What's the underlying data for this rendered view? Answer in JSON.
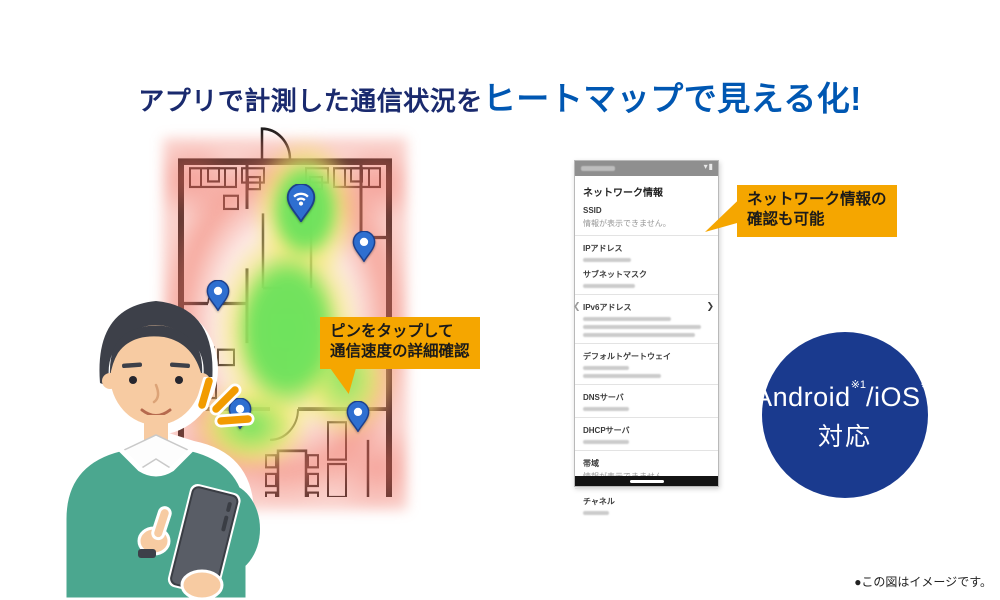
{
  "title": {
    "part1": "アプリで計測した通信状況を",
    "part2": "ヒートマップで見える化!"
  },
  "callout_pin": {
    "lines": [
      "ピンをタップして",
      "通信速度の詳細確認"
    ]
  },
  "callout_network": {
    "lines": [
      "ネットワーク情報の",
      "確認も可能"
    ]
  },
  "badge": {
    "platform_left": "Android",
    "sup1": "※1",
    "platform_right": "/iOS",
    "sup2": "※2",
    "caption": "対応"
  },
  "phone": {
    "title": "ネットワーク情報",
    "status_icons": [
      "wifi-icon",
      "battery-icon"
    ],
    "rows": [
      {
        "label": "SSID",
        "value": "情報が表示できません。",
        "divider": true
      },
      {
        "label": "IPアドレス",
        "masked": [
          48
        ]
      },
      {
        "label": "サブネットマスク",
        "masked": [
          52
        ],
        "divider": true
      },
      {
        "label": "IPv6アドレス",
        "masked": [
          88,
          118,
          112
        ],
        "chevrons": true,
        "divider": true
      },
      {
        "label": "デフォルトゲートウェイ",
        "masked": [
          46,
          78
        ],
        "divider": true
      },
      {
        "label": "DNSサーバ",
        "masked": [
          46
        ],
        "divider": true
      },
      {
        "label": "DHCPサーバ",
        "masked": [
          46
        ],
        "divider": true
      },
      {
        "label": "帯域",
        "value": "情報が表示できません。",
        "divider": true
      },
      {
        "label": "チャネル",
        "masked": [
          26
        ]
      }
    ]
  },
  "floorplan": {
    "heat_colors": {
      "signal_strong": "#69e25c",
      "signal_medium": "#f2eb6a",
      "signal_weak": "#ef7562"
    },
    "pins": [
      {
        "type": "router",
        "x": 301,
        "y": 221
      },
      {
        "type": "spot",
        "x": 364,
        "y": 261
      },
      {
        "type": "spot",
        "x": 218,
        "y": 310
      },
      {
        "type": "spot",
        "x": 240,
        "y": 428
      },
      {
        "type": "spot",
        "x": 358,
        "y": 431
      }
    ]
  },
  "footnote": "●この図はイメージです。",
  "colors": {
    "accent_orange": "#f5a600",
    "title_navy": "#1a2a6e",
    "title_blue": "#0057b2",
    "badge_navy": "#1a3a8e",
    "pin_blue": "#2e6fd0"
  }
}
